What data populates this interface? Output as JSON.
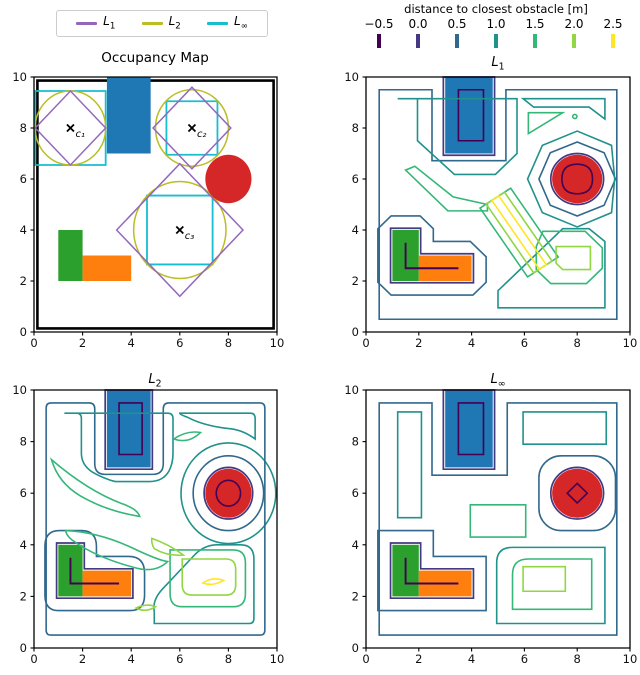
{
  "header": {
    "legend": {
      "items": [
        {
          "base": "L",
          "sub": "1",
          "color": "#9467bd"
        },
        {
          "base": "L",
          "sub": "2",
          "color": "#bcbd22"
        },
        {
          "base": "L",
          "sub": "∞",
          "color": "#17becf"
        }
      ]
    },
    "colorbar": {
      "title": "distance to closest obstacle [m]",
      "ticks": [
        {
          "label": "−0.5",
          "color": "#440154"
        },
        {
          "label": "0.0",
          "color": "#443983"
        },
        {
          "label": "0.5",
          "color": "#31688e"
        },
        {
          "label": "1.0",
          "color": "#21918c"
        },
        {
          "label": "1.5",
          "color": "#35b779"
        },
        {
          "label": "2.0",
          "color": "#90d743"
        },
        {
          "label": "2.5",
          "color": "#fde725"
        }
      ]
    }
  },
  "panels": [
    {
      "title_base": "Occupancy Map",
      "title_sub": ""
    },
    {
      "title_base": "L",
      "title_sub": "1"
    },
    {
      "title_base": "L",
      "title_sub": "2"
    },
    {
      "title_base": "L",
      "title_sub": "∞"
    }
  ],
  "axes": {
    "x_ticks": [
      "0",
      "2",
      "4",
      "6",
      "8",
      "10"
    ],
    "y_ticks": [
      "0",
      "2",
      "4",
      "6",
      "8",
      "10"
    ]
  },
  "chart_data": [
    {
      "type": "map",
      "title": "Occupancy Map",
      "xlim": [
        0,
        10
      ],
      "ylim": [
        0,
        10
      ],
      "obstacles": {
        "boundary_wall": {
          "rect": [
            0.14,
            0.14,
            9.86,
            9.86
          ],
          "color": "#000000"
        },
        "blue_rectangle": {
          "rect": [
            3,
            7,
            4.8,
            10
          ],
          "color": "#1f77b4"
        },
        "red_circle": {
          "center": [
            8,
            6
          ],
          "radius": 0.95,
          "color": "#d62728"
        },
        "green_rectangle": {
          "rect": [
            1,
            2,
            2,
            4
          ],
          "color": "#2ca02c"
        },
        "orange_rectangle": {
          "rect": [
            2,
            2,
            4,
            3
          ],
          "color": "#ff7f0e"
        }
      },
      "query_points": [
        {
          "name": "c₁",
          "xy": [
            1.5,
            8
          ],
          "ball_radius_L1": 1.45,
          "ball_radius_L2": 1.45,
          "ball_radius_Linf": 1.45
        },
        {
          "name": "c₂",
          "xy": [
            6.5,
            8
          ],
          "ball_radius_L1": 1.6,
          "ball_radius_L2": 1.5,
          "ball_radius_Linf": 1.05
        },
        {
          "name": "c₃",
          "xy": [
            6,
            4
          ],
          "ball_radius_L1": 2.6,
          "ball_radius_L2": 1.9,
          "ball_radius_Linf": 1.35
        }
      ],
      "ball_colors": {
        "L1": "#9467bd",
        "L2": "#bcbd22",
        "Linf": "#17becf"
      }
    },
    {
      "type": "contour",
      "title": "L₁",
      "norm": "L1",
      "xlim": [
        0,
        10
      ],
      "ylim": [
        0,
        10
      ],
      "field": "distance to closest obstacle [m]",
      "colormap": "viridis",
      "levels": [
        -0.5,
        0,
        0.5,
        1,
        1.5,
        2,
        2.5
      ],
      "level_colors": [
        "#440154",
        "#443983",
        "#31688e",
        "#21918c",
        "#35b779",
        "#90d743",
        "#fde725"
      ]
    },
    {
      "type": "contour",
      "title": "L₂",
      "norm": "L2",
      "xlim": [
        0,
        10
      ],
      "ylim": [
        0,
        10
      ],
      "field": "distance to closest obstacle [m]",
      "colormap": "viridis",
      "levels": [
        -0.5,
        0,
        0.5,
        1,
        1.5,
        2,
        2.5
      ],
      "level_colors": [
        "#440154",
        "#443983",
        "#31688e",
        "#21918c",
        "#35b779",
        "#90d743",
        "#fde725"
      ]
    },
    {
      "type": "contour",
      "title": "L∞",
      "norm": "Linf",
      "xlim": [
        0,
        10
      ],
      "ylim": [
        0,
        10
      ],
      "field": "distance to closest obstacle [m]",
      "colormap": "viridis",
      "levels": [
        -0.5,
        0,
        0.5,
        1,
        1.5,
        2,
        2.5
      ],
      "level_colors": [
        "#440154",
        "#443983",
        "#31688e",
        "#21918c",
        "#35b779",
        "#90d743",
        "#fde725"
      ]
    }
  ]
}
